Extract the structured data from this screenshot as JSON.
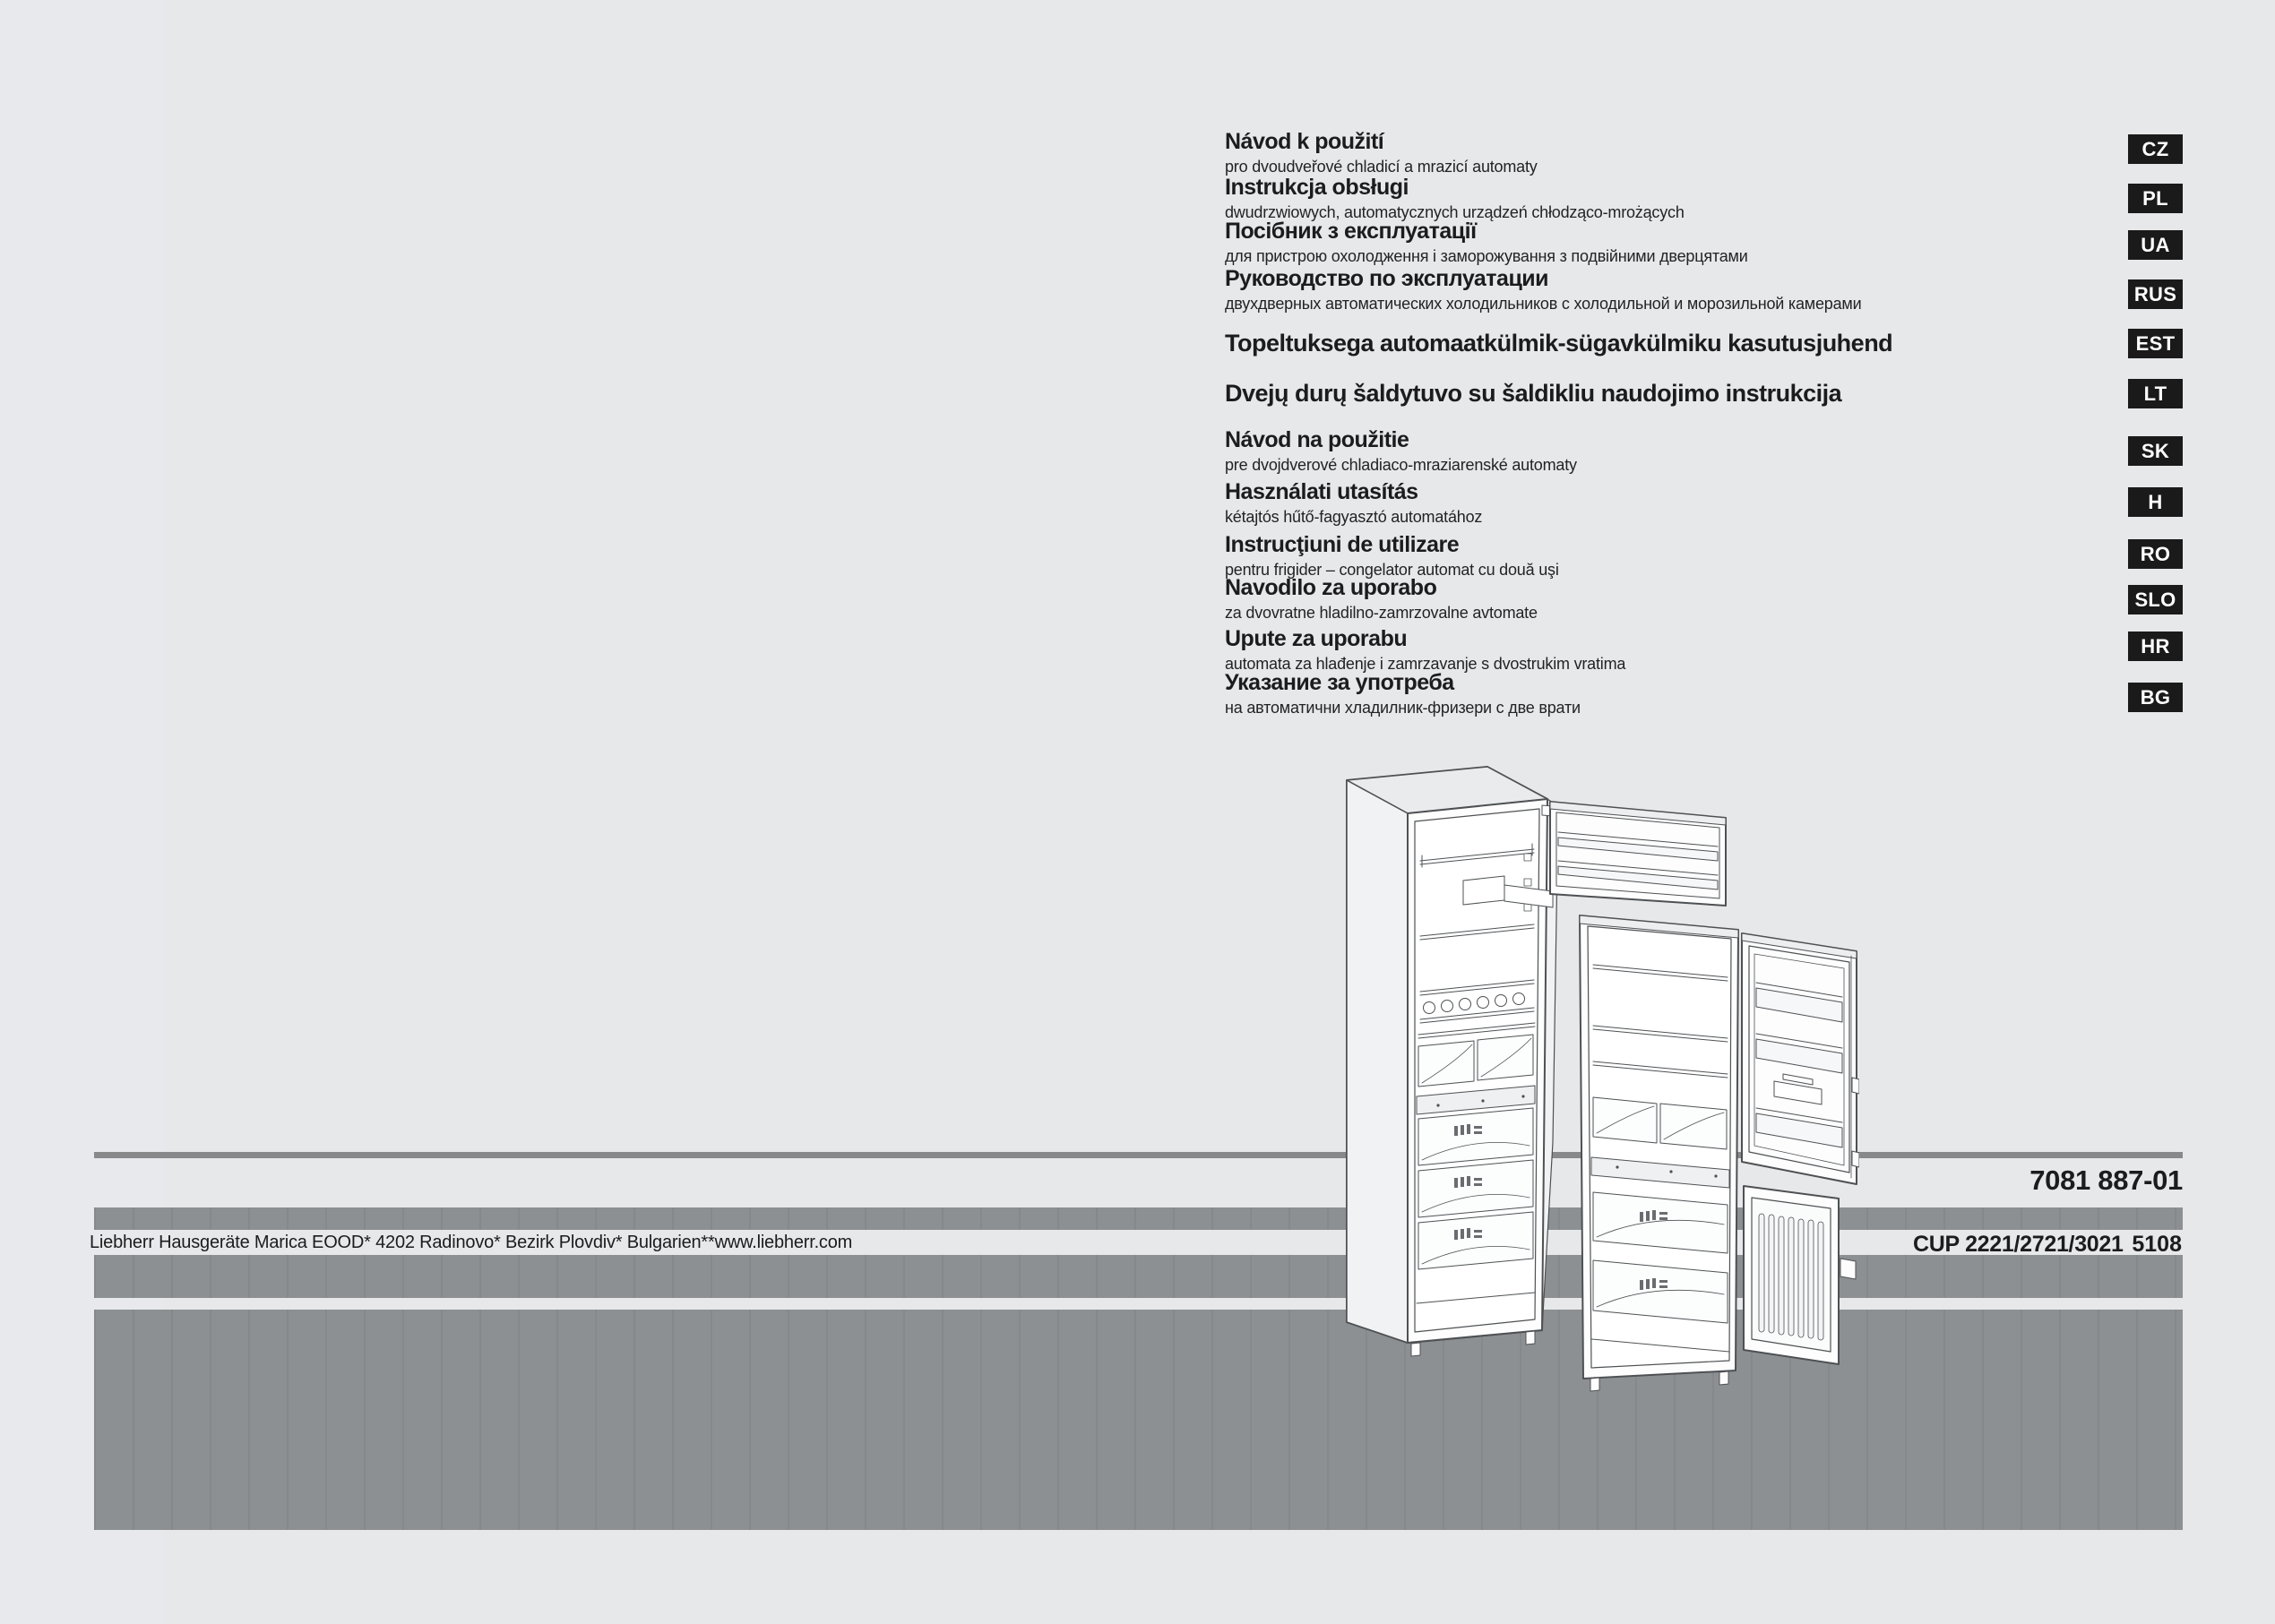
{
  "page": {
    "kind": "instruction-manual-cover",
    "brand": "Liebherr"
  },
  "languages": [
    {
      "code": "CZ",
      "title": "Návod k použití",
      "subtitle": "pro dvoudveřové chladicí a mrazicí automaty"
    },
    {
      "code": "PL",
      "title": "Instrukcja obsługi",
      "subtitle": "dwudrzwiowych, automatycznych urządzeń chłodząco-mrożących"
    },
    {
      "code": "UA",
      "title": "Посібник з експлуатації",
      "subtitle": "для пристрою охолодження і заморожування з подвійними дверцятами"
    },
    {
      "code": "RUS",
      "title": "Руководство по эксплуатации",
      "subtitle": "двухдверных автоматических холодильников с холодильной и морозильной камерами"
    },
    {
      "code": "EST",
      "title": "Topeltuksega automaatkülmik-sügavkülmiku kasutusjuhend",
      "subtitle": ""
    },
    {
      "code": "LT",
      "title": "Dvejų durų šaldytuvo su šaldikliu naudojimo instrukcija",
      "subtitle": ""
    },
    {
      "code": "SK",
      "title": "Návod na použitie",
      "subtitle": "pre dvojdverové chladiaco-mraziarenské automaty"
    },
    {
      "code": "H",
      "title": "Használati utasítás",
      "subtitle": "kétajtós hűtő-fagyasztó automatához"
    },
    {
      "code": "RO",
      "title": "Instrucţiuni de utilizare",
      "subtitle": "pentru frigider – congelator automat cu două uşi"
    },
    {
      "code": "SLO",
      "title": "Navodilo za uporabo",
      "subtitle": "za dvovratne hladilno-zamrzovalne avtomate"
    },
    {
      "code": "HR",
      "title": "Upute za uporabu",
      "subtitle": "automata za hlađenje i zamrzavanje s dvostrukim vratima"
    },
    {
      "code": "BG",
      "title": "Указание за употреба",
      "subtitle": "на автоматични хладилник-фризери с две врати"
    }
  ],
  "footer": {
    "doc_number": "7081 887-01",
    "address": "Liebherr Hausgeräte Marica EOOD* 4202 Radinovo* Bezirk Plovdiv* Bulgarien**www.liebherr.com",
    "models": "CUP 2221/2721/3021",
    "service_code": "5108"
  },
  "illustration": {
    "description": "Technical line drawing of two two-door fridge-freezer appliances with open doors showing shelves, drawers and door bins"
  },
  "colors": {
    "background": "#e7e8ea",
    "bar_gray": "#8b8e90",
    "badge_bg": "#1a1a1a",
    "badge_text": "#ffffff",
    "text": "#1c1c1e"
  }
}
